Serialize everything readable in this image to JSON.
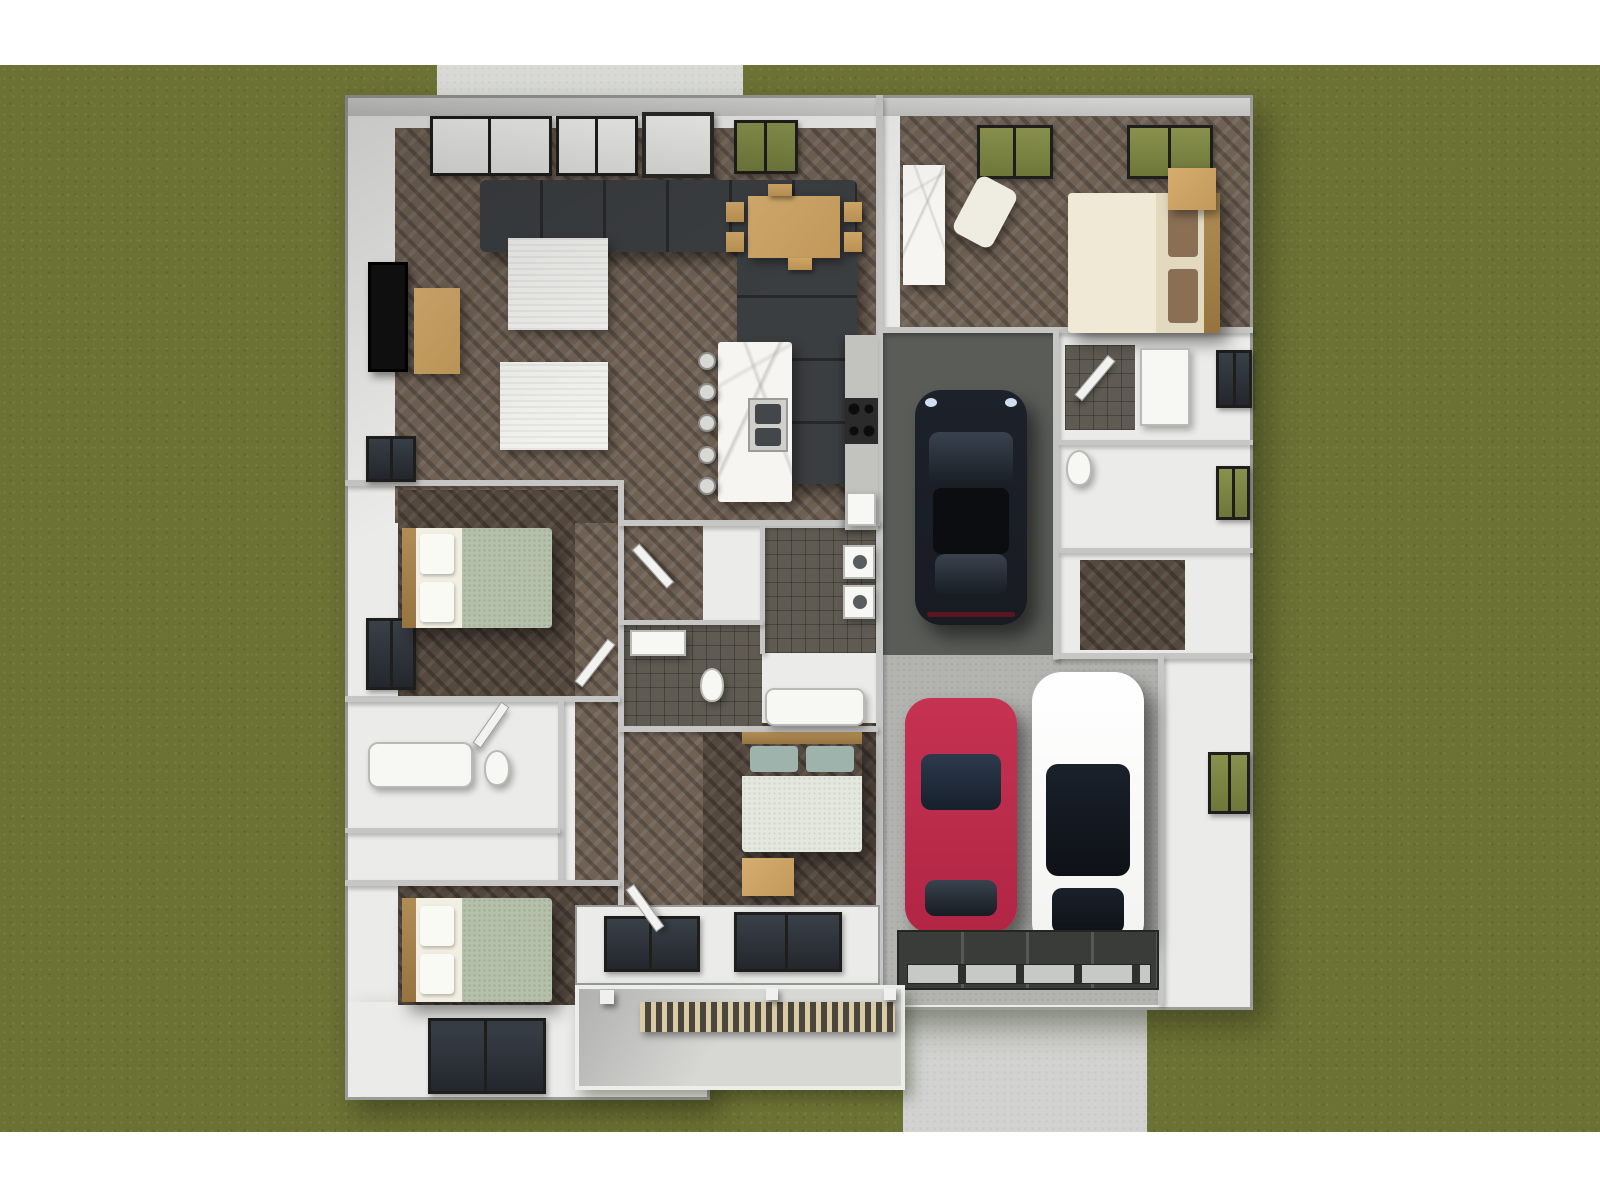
{
  "scene": {
    "type": "3d-floor-plan-top-view",
    "setting": "single-story house with attached two-bay garage on a lawn",
    "exterior": {
      "lawn": "olive green grass filling the lot",
      "front_walkway": "concrete path at top leading to front door",
      "driveway": "concrete driveway at bottom right below garage",
      "covered_porch": "rear covered patio with wood-slat railing and posts at bottom center",
      "margins": "white strips at very top and bottom of the image"
    },
    "rooms": [
      {
        "name": "great room",
        "contents": [
          "L-shaped charcoal sectional sofa",
          "two white area rugs",
          "wall-mounted TV",
          "wood media console",
          "herringbone wood floor"
        ]
      },
      {
        "name": "dining area",
        "contents": [
          "light wood dining table",
          "six wood chairs",
          "front door with glass"
        ]
      },
      {
        "name": "kitchen",
        "contents": [
          "white marble island with double sink",
          "five round bar stools",
          "perimeter counter with black cooktop"
        ]
      },
      {
        "name": "entry hall",
        "contents": [
          "marble pantry counter",
          "herringbone wood floor"
        ]
      },
      {
        "name": "master bedroom",
        "contents": [
          "bed with cream duvet and brown pillows",
          "wood headboard",
          "wood nightstand dresser",
          "white armchair",
          "two grass-view windows"
        ]
      },
      {
        "name": "master bathroom",
        "contents": [
          "dark tiled shower",
          "white vanity",
          "toilet",
          "two right-wall windows"
        ]
      },
      {
        "name": "walk-in closet",
        "contents": [
          "dark wood floor"
        ]
      },
      {
        "name": "bedroom 2",
        "contents": [
          "bed with sage duvet and white pillows",
          "wood headboard",
          "left-wall windows"
        ]
      },
      {
        "name": "bedroom 3",
        "contents": [
          "bed with sage duvet and white pillows",
          "wood headboard",
          "large bottom-wall window"
        ]
      },
      {
        "name": "bedroom 4",
        "contents": [
          "bed with teal pillows",
          "wood cabinet"
        ]
      },
      {
        "name": "hall bathroom",
        "contents": [
          "white tub",
          "toilet"
        ]
      },
      {
        "name": "center bathroom",
        "contents": [
          "toilet",
          "vanity",
          "dark tile floor"
        ]
      },
      {
        "name": "laundry room",
        "contents": [
          "stacked white washer and dryer",
          "dark tile floor"
        ]
      },
      {
        "name": "garage",
        "contents": [
          "dark concrete single bay",
          "light concrete double bay",
          "glass-paneled garage door"
        ]
      }
    ],
    "vehicles": [
      {
        "name": "black sports car",
        "bay": "upper single bay",
        "facing": "down"
      },
      {
        "name": "red car",
        "bay": "lower bay left",
        "facing": "up"
      },
      {
        "name": "white car with black glass roof",
        "bay": "lower bay right",
        "facing": "up"
      }
    ]
  },
  "palette": {
    "page_bg": "#ffffff",
    "grass": "#6c7134",
    "walkway": "#d9dad6",
    "driveway": "#d2d3d0",
    "house": "#ebebe9",
    "eave": "#c7c7c5",
    "wall_line": "#c6c6c4",
    "outline": "#9b9b99",
    "wood": "#6f6154",
    "wood_dark": "#55493f",
    "rug": "#f1f1ee",
    "sofa": "#3b3e41",
    "wood_furn": "#c9a260",
    "marble": "#f6f5f2",
    "counter": "#c2c3bf",
    "tile_dark": "#5f5b52",
    "garage_dark": "#5a5c58",
    "garage_light": "#b3b4b0",
    "garage_door": "#3a3c3a",
    "car_black": "#181b22",
    "car_red": "#b22544",
    "car_white": "#f2f3f1",
    "glass_dark": "#262d36",
    "bed_sage": "#b4c0aa",
    "bed_cream": "#efe9d6",
    "pillow_brown": "#8a6f54",
    "bed_teal": "#9fb3ad",
    "window_frame": "#1e1e1c",
    "pane_light": "#eef0ec",
    "pane_green": "#79823f",
    "pane_dark": "#2e343b",
    "porch_concrete": "#d7d8d4"
  }
}
